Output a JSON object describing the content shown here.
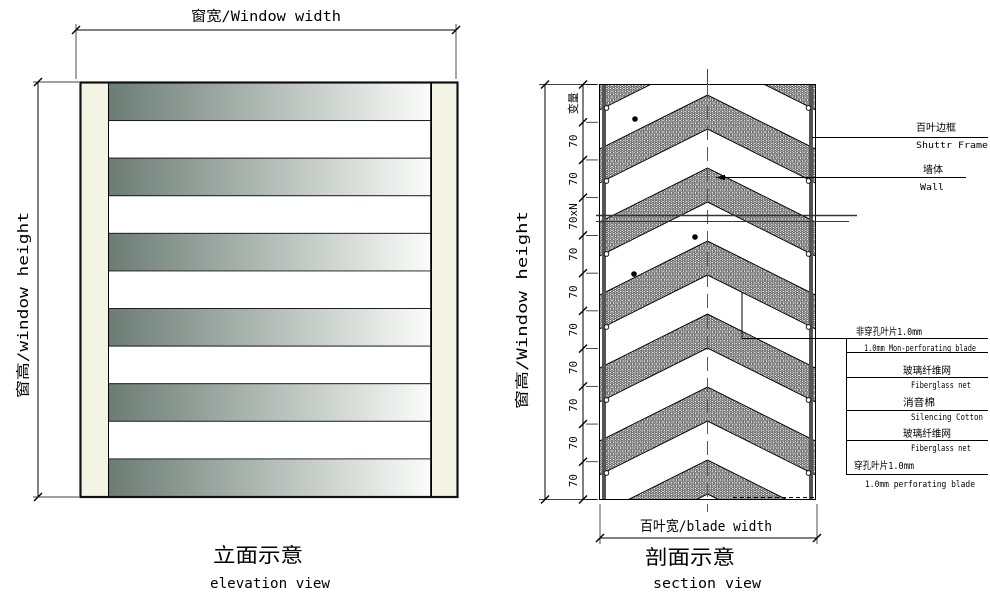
{
  "elevation": {
    "width_label": "窗宽/Window width",
    "height_label": "窗高/window height",
    "caption_zh": "立面示意",
    "caption_en": "elevation view",
    "blade_count": 11
  },
  "section": {
    "height_label": "窗高/Window height",
    "blade_width_label": "百叶宽/blade width",
    "caption_zh": "剖面示意",
    "caption_en": "section view",
    "dim_segments": [
      "变量",
      "70",
      "70",
      "70xN",
      "70",
      "70",
      "70",
      "70",
      "70",
      "70",
      "70"
    ],
    "annotations": [
      {
        "zh": "百叶边框",
        "en": "Shuttr Frame"
      },
      {
        "zh": "墙体",
        "en": "Wall"
      },
      {
        "zh": "非穿孔叶片1.0mm",
        "en": "1.0mm Mon-perforating blade"
      },
      {
        "zh": "玻璃纤维网",
        "en": "Fiberglass net"
      },
      {
        "zh": "消音棉",
        "en": "Silencing Cotton"
      },
      {
        "zh": "玻璃纤维网",
        "en": "Fiberglass net"
      },
      {
        "zh": "穿孔叶片1.0mm",
        "en": "1.0mm perforating blade"
      }
    ]
  },
  "colors": {
    "blade_dark": "#6b7c75",
    "blade_light": "#fbfcfa",
    "frame_fill": "#f3f4e4",
    "line": "#000000",
    "gray_line": "#555555"
  }
}
